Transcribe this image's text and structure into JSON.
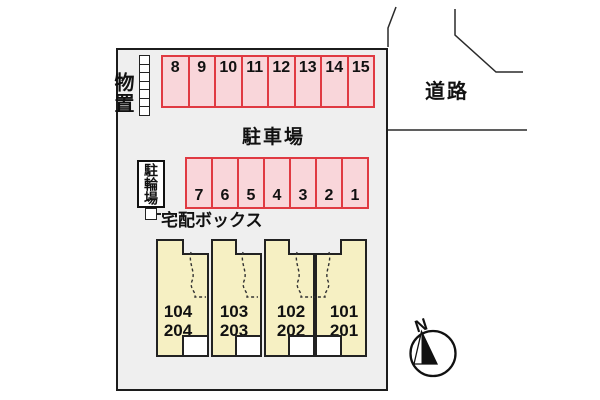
{
  "site": {
    "parking_lot_label": "駐車場",
    "storage_label": "物置",
    "bicycle_parking_label": "駐輪場",
    "delivery_box_label": "宅配ボックス",
    "road_label": "道路",
    "compass_north_label": "N"
  },
  "parking": {
    "upper_row": {
      "spaces": [
        "8",
        "9",
        "10",
        "11",
        "12",
        "13",
        "14",
        "15"
      ]
    },
    "lower_row": {
      "spaces": [
        "7",
        "6",
        "5",
        "4",
        "3",
        "2",
        "1"
      ]
    }
  },
  "storage": {
    "cell_count": 7
  },
  "building": {
    "units": [
      {
        "floor1": "104",
        "floor2": "204"
      },
      {
        "floor1": "103",
        "floor2": "203"
      },
      {
        "floor1": "102",
        "floor2": "202"
      },
      {
        "floor1": "101",
        "floor2": "201"
      }
    ]
  },
  "colors": {
    "parking_fill": "#f9d6da",
    "parking_border": "#e03a42",
    "building_fill": "#f6f0c3",
    "parcel_fill": "#efefef",
    "line": "#1c1c1c"
  }
}
